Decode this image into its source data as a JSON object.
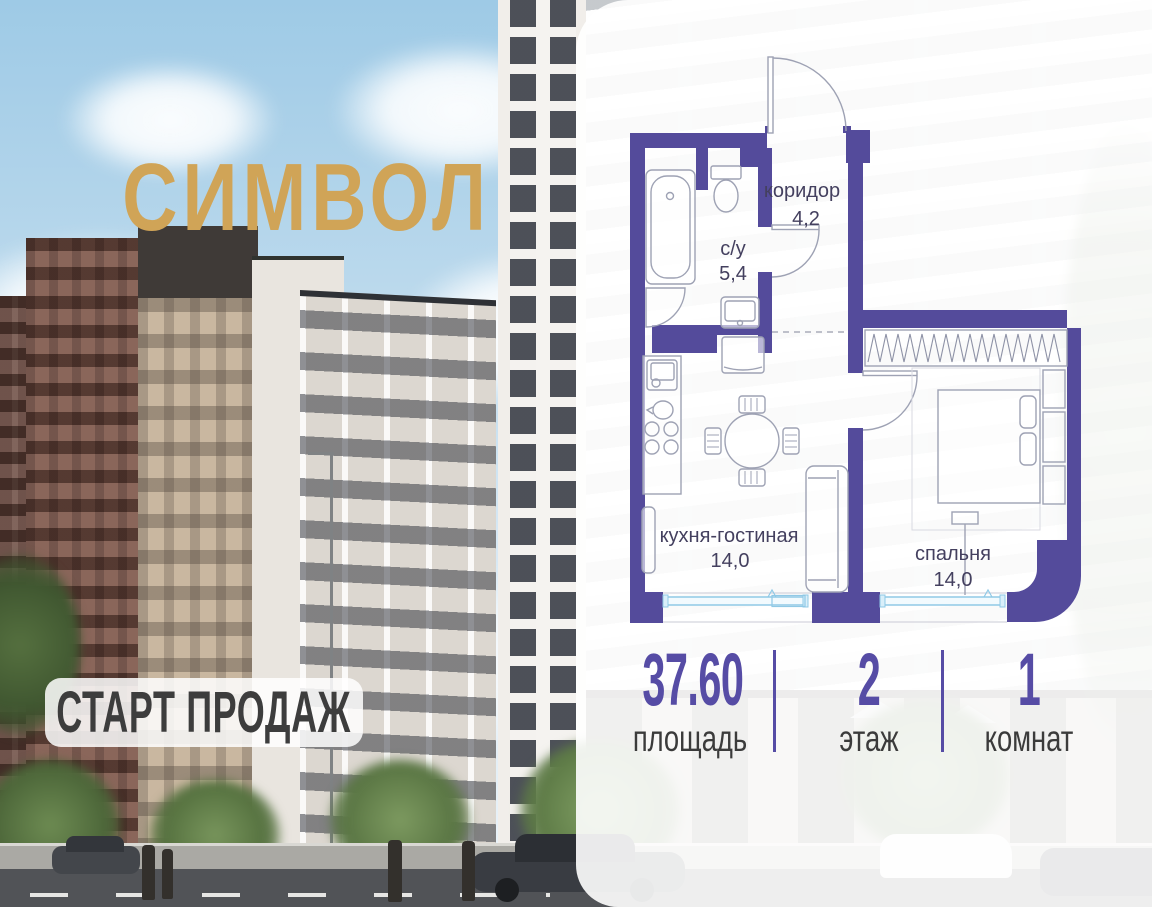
{
  "brand": {
    "name": "СИМВОЛ",
    "color": "#D0A457"
  },
  "badge": {
    "label": "СТАРТ ПРОДАЖ"
  },
  "floor_plan": {
    "wall_color": "#544B9B",
    "rooms": [
      {
        "id": "corridor",
        "name": "коридор",
        "area": "4,2"
      },
      {
        "id": "bathroom",
        "name": "с/у",
        "area": "5,4"
      },
      {
        "id": "kitchen-living",
        "name": "кухня-гостиная",
        "area": "14,0"
      },
      {
        "id": "bedroom",
        "name": "спальня",
        "area": "14,0"
      }
    ]
  },
  "stats": [
    {
      "value": "37.60",
      "label": "площадь"
    },
    {
      "value": "2",
      "label": "этаж"
    },
    {
      "value": "1",
      "label": "комнат"
    }
  ],
  "colors": {
    "accent_purple": "#564CA5",
    "logo_gold": "#D0A457",
    "window_blue": "#90C9E6",
    "label_dark": "#3B3B3B"
  }
}
